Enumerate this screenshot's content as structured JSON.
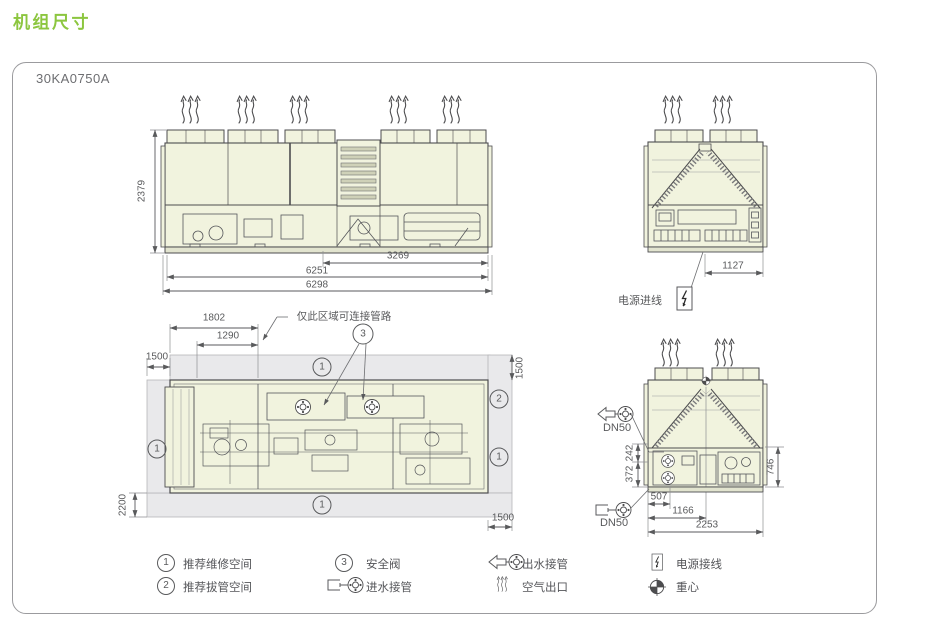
{
  "title": "机组尺寸",
  "model": "30KA0750A",
  "front": {
    "height": "2379",
    "inner_width": "3269",
    "mid_width": "6251",
    "total_width": "6298"
  },
  "side_top": {
    "width": "1127",
    "power_label": "电源进线"
  },
  "plan": {
    "note": "仅此区域可连接管路",
    "dim_1802": "1802",
    "dim_1290": "1290",
    "left_clearance": "1500",
    "top_clearance": "1500",
    "bottom_clearance": "2200",
    "right_clearance": "1500",
    "callout_top": "1",
    "callout_left": "1",
    "callout_right_upper": "2",
    "callout_right_lower": "1",
    "callout_bottom": "1",
    "callout_valve": "3"
  },
  "side_bottom": {
    "outlet_dn": "DN50",
    "inlet_dn": "DN50",
    "dim_242": "242",
    "dim_372": "372",
    "dim_746": "746",
    "dim_507": "507",
    "dim_1166": "1166",
    "dim_2253": "2253"
  },
  "legend": {
    "items": [
      {
        "num": "1",
        "icon": "circle-1-icon",
        "label": "推荐维修空间"
      },
      {
        "num": "3",
        "icon": "circle-3-icon",
        "label": "安全阀"
      },
      {
        "icon": "water-outlet-icon",
        "label": "出水接管"
      },
      {
        "icon": "power-icon",
        "label": "电源接线"
      },
      {
        "num": "2",
        "icon": "circle-2-icon",
        "label": "推荐拔管空间"
      },
      {
        "icon": "water-inlet-icon",
        "label": "进水接管"
      },
      {
        "icon": "air-outlet-icon",
        "label": "空气出口"
      },
      {
        "icon": "gravity-center-icon",
        "label": "重心"
      }
    ]
  },
  "colors": {
    "accent_green": "#8CC63F",
    "unit_fill": "#F1F3DE",
    "line": "#4D4D4F",
    "dim_text": "#58595B",
    "clearance_band": "#E9E9EB"
  }
}
